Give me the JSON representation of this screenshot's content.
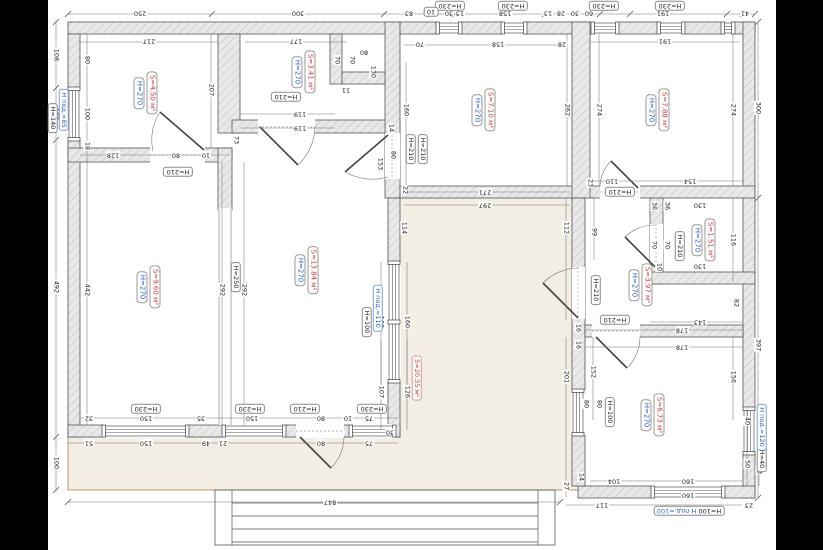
{
  "title": "floor-plan-drawing",
  "colors": {
    "background_bars": "#000000",
    "paper": "#ffffff",
    "wall_fill": "#e9e9e9",
    "wall_hatch": "#c2c2c2",
    "wall_stroke": "#555555",
    "dimension_line": "#777777",
    "text": "#222222",
    "height_tag_blue": "#2b62c4",
    "area_tag_red": "#cc3a3a",
    "terrace_fill": "#f3eee3",
    "terrace_edge": "#c8966b"
  },
  "rooms": [
    {
      "height": "H=270",
      "area": "S=4.50 м²",
      "x": 145,
      "y": 93
    },
    {
      "height": "H=270",
      "area": "S=3.41 м²",
      "x": 303,
      "y": 72
    },
    {
      "height": "H=270",
      "area": "S=7.10 м²",
      "x": 483,
      "y": 110
    },
    {
      "height": "H=270",
      "area": "S=7.88 м²",
      "x": 657,
      "y": 110
    },
    {
      "height": "H=270",
      "area": "S=9.60 м²",
      "x": 148,
      "y": 287
    },
    {
      "height": "H=270",
      "area": "S=13.84 м²",
      "x": 306,
      "y": 270
    },
    {
      "height": "H=270",
      "area": "S=1.51 м²",
      "x": 703,
      "y": 240
    },
    {
      "height": "H=270",
      "area": "S=3.97 м²",
      "x": 640,
      "y": 285
    },
    {
      "height": "H=270",
      "area": "S=6.73 м²",
      "x": 652,
      "y": 415
    }
  ],
  "area_tags": [
    {
      "text": "S=20.35 м²",
      "x": 417,
      "y": 378,
      "o": "v"
    }
  ],
  "height_tags": [
    {
      "text": "H=210",
      "x": 178,
      "y": 172,
      "o": "h"
    },
    {
      "text": "H=210",
      "x": 286,
      "y": 97,
      "o": "h"
    },
    {
      "text": "H=210",
      "x": 411,
      "y": 149,
      "o": "v"
    },
    {
      "text": "H=210",
      "x": 423,
      "y": 149,
      "o": "v"
    },
    {
      "text": "H=210",
      "x": 620,
      "y": 192,
      "o": "h"
    },
    {
      "text": "H=210",
      "x": 680,
      "y": 246,
      "o": "v"
    },
    {
      "text": "H=210",
      "x": 596,
      "y": 290,
      "o": "v"
    },
    {
      "text": "H=210",
      "x": 615,
      "y": 320,
      "o": "h"
    },
    {
      "text": "H=210",
      "x": 305,
      "y": 409,
      "o": "h"
    },
    {
      "text": "H=250",
      "x": 236,
      "y": 277,
      "o": "v"
    },
    {
      "text": "H=230",
      "x": 450,
      "y": 6,
      "o": "h"
    },
    {
      "text": "H=230",
      "x": 513,
      "y": 6,
      "o": "h"
    },
    {
      "text": "H=230",
      "x": 604,
      "y": 6,
      "o": "h"
    },
    {
      "text": "H=230",
      "x": 670,
      "y": 6,
      "o": "h"
    },
    {
      "text": "H=230",
      "x": 146,
      "y": 409,
      "o": "h"
    },
    {
      "text": "H=230",
      "x": 250,
      "y": 409,
      "o": "h"
    },
    {
      "text": "H=230",
      "x": 372,
      "y": 409,
      "o": "h"
    },
    {
      "text": "H=140",
      "x": 53,
      "y": 118,
      "o": "v"
    },
    {
      "text": "H=100",
      "x": 367,
      "y": 322,
      "o": "v"
    },
    {
      "text": "H=100",
      "x": 610,
      "y": 412,
      "o": "v"
    },
    {
      "text": "H=40",
      "x": 762,
      "y": 459,
      "o": "v"
    },
    {
      "text": "10",
      "x": 431,
      "y": 12,
      "o": "h"
    }
  ],
  "sill_tags": [
    {
      "text": "H под.=85",
      "x": 64,
      "y": 110,
      "o": "v"
    },
    {
      "text": "H под.=110",
      "x": 378,
      "y": 308,
      "o": "v"
    },
    {
      "text": "H под.=120",
      "x": 762,
      "y": 427,
      "o": "v"
    }
  ],
  "combo_tag": {
    "black": "H=100",
    "blue": "H под.=100",
    "x": 689,
    "y": 511
  },
  "dimensions": [
    {
      "t": "250",
      "x": 140,
      "y": 13,
      "o": "h"
    },
    {
      "t": "300",
      "x": 298,
      "y": 13,
      "o": "h"
    },
    {
      "t": "83",
      "x": 409,
      "y": 13,
      "o": "h"
    },
    {
      "t": "30",
      "x": 449,
      "y": 13,
      "o": "h"
    },
    {
      "t": "13",
      "x": 460,
      "y": 13,
      "o": "h"
    },
    {
      "t": "158",
      "x": 505,
      "y": 13,
      "o": "h"
    },
    {
      "t": "13",
      "x": 548,
      "y": 13,
      "o": "h"
    },
    {
      "t": "28",
      "x": 561,
      "y": 13,
      "o": "h"
    },
    {
      "t": "30",
      "x": 575,
      "y": 13,
      "o": "h"
    },
    {
      "t": "60",
      "x": 589,
      "y": 13,
      "o": "h"
    },
    {
      "t": "191",
      "x": 663,
      "y": 13,
      "o": "h"
    },
    {
      "t": "41",
      "x": 745,
      "y": 13,
      "o": "h"
    },
    {
      "t": "217",
      "x": 149,
      "y": 41,
      "o": "h"
    },
    {
      "t": "177",
      "x": 296,
      "y": 41,
      "o": "h"
    },
    {
      "t": "70",
      "x": 420,
      "y": 44,
      "o": "h"
    },
    {
      "t": "158",
      "x": 498,
      "y": 44,
      "o": "h"
    },
    {
      "t": "28",
      "x": 562,
      "y": 44,
      "o": "h"
    },
    {
      "t": "191",
      "x": 665,
      "y": 41,
      "o": "h"
    },
    {
      "t": "108",
      "x": 56,
      "y": 55,
      "o": "v"
    },
    {
      "t": "100",
      "x": 56,
      "y": 114,
      "o": "v"
    },
    {
      "t": "492",
      "x": 56,
      "y": 287,
      "o": "v"
    },
    {
      "t": "100",
      "x": 56,
      "y": 463,
      "o": "v"
    },
    {
      "t": "80",
      "x": 87,
      "y": 60,
      "o": "v"
    },
    {
      "t": "100",
      "x": 87,
      "y": 114,
      "o": "v"
    },
    {
      "t": "18",
      "x": 87,
      "y": 146,
      "o": "v"
    },
    {
      "t": "442",
      "x": 87,
      "y": 290,
      "o": "v"
    },
    {
      "t": "207",
      "x": 211,
      "y": 90,
      "o": "v"
    },
    {
      "t": "128",
      "x": 113,
      "y": 155,
      "o": "h"
    },
    {
      "t": "80",
      "x": 176,
      "y": 155,
      "o": "h"
    },
    {
      "t": "10",
      "x": 206,
      "y": 155,
      "o": "h"
    },
    {
      "t": "119",
      "x": 300,
      "y": 114,
      "o": "h"
    },
    {
      "t": "119",
      "x": 300,
      "y": 128,
      "o": "h"
    },
    {
      "t": "70",
      "x": 337,
      "y": 60,
      "o": "v"
    },
    {
      "t": "70",
      "x": 352,
      "y": 60,
      "o": "v"
    },
    {
      "t": "80",
      "x": 364,
      "y": 52,
      "o": "h"
    },
    {
      "t": "11",
      "x": 346,
      "y": 90,
      "o": "h"
    },
    {
      "t": "130",
      "x": 373,
      "y": 72,
      "o": "v"
    },
    {
      "t": "14",
      "x": 391,
      "y": 128,
      "o": "v"
    },
    {
      "t": "73",
      "x": 236,
      "y": 140,
      "o": "v"
    },
    {
      "t": "80",
      "x": 393,
      "y": 155,
      "o": "v"
    },
    {
      "t": "160",
      "x": 406,
      "y": 110,
      "o": "v"
    },
    {
      "t": "292",
      "x": 222,
      "y": 290,
      "o": "v"
    },
    {
      "t": "292",
      "x": 244,
      "y": 290,
      "o": "v"
    },
    {
      "t": "153",
      "x": 380,
      "y": 164,
      "o": "v"
    },
    {
      "t": "114",
      "x": 404,
      "y": 228,
      "o": "v"
    },
    {
      "t": "160",
      "x": 381,
      "y": 322,
      "o": "v"
    },
    {
      "t": "160",
      "x": 407,
      "y": 322,
      "o": "v"
    },
    {
      "t": "271",
      "x": 485,
      "y": 192,
      "o": "h"
    },
    {
      "t": "297",
      "x": 485,
      "y": 205,
      "o": "h"
    },
    {
      "t": "22",
      "x": 405,
      "y": 190,
      "o": "v"
    },
    {
      "t": "107",
      "x": 381,
      "y": 392,
      "o": "v"
    },
    {
      "t": "126",
      "x": 407,
      "y": 392,
      "o": "v"
    },
    {
      "t": "30",
      "x": 390,
      "y": 432,
      "o": "h"
    },
    {
      "t": "75",
      "x": 369,
      "y": 418,
      "o": "h"
    },
    {
      "t": "75",
      "x": 369,
      "y": 443,
      "o": "h"
    },
    {
      "t": "32",
      "x": 89,
      "y": 418,
      "o": "h"
    },
    {
      "t": "150",
      "x": 146,
      "y": 418,
      "o": "h"
    },
    {
      "t": "35",
      "x": 201,
      "y": 418,
      "o": "h"
    },
    {
      "t": "150",
      "x": 252,
      "y": 418,
      "o": "h"
    },
    {
      "t": "80",
      "x": 321,
      "y": 418,
      "o": "h"
    },
    {
      "t": "10",
      "x": 348,
      "y": 418,
      "o": "h"
    },
    {
      "t": "51",
      "x": 89,
      "y": 443,
      "o": "h"
    },
    {
      "t": "150",
      "x": 146,
      "y": 443,
      "o": "h"
    },
    {
      "t": "49",
      "x": 206,
      "y": 443,
      "o": "h"
    },
    {
      "t": "21",
      "x": 223,
      "y": 443,
      "o": "h"
    },
    {
      "t": "80",
      "x": 321,
      "y": 443,
      "o": "h"
    },
    {
      "t": "847",
      "x": 330,
      "y": 502,
      "o": "h"
    },
    {
      "t": "262",
      "x": 567,
      "y": 110,
      "o": "v"
    },
    {
      "t": "274",
      "x": 599,
      "y": 110,
      "o": "v"
    },
    {
      "t": "274",
      "x": 733,
      "y": 110,
      "o": "v"
    },
    {
      "t": "300",
      "x": 758,
      "y": 108,
      "o": "v"
    },
    {
      "t": "110",
      "x": 612,
      "y": 181,
      "o": "h"
    },
    {
      "t": "154",
      "x": 690,
      "y": 181,
      "o": "h"
    },
    {
      "t": "23",
      "x": 590,
      "y": 183,
      "o": "v"
    },
    {
      "t": "112",
      "x": 566,
      "y": 228,
      "o": "v"
    },
    {
      "t": "99",
      "x": 594,
      "y": 232,
      "o": "v"
    },
    {
      "t": "36",
      "x": 654,
      "y": 206,
      "o": "v"
    },
    {
      "t": "36",
      "x": 667,
      "y": 206,
      "o": "v"
    },
    {
      "t": "130",
      "x": 700,
      "y": 205,
      "o": "h"
    },
    {
      "t": "116",
      "x": 733,
      "y": 240,
      "o": "v"
    },
    {
      "t": "70",
      "x": 654,
      "y": 245,
      "o": "v"
    },
    {
      "t": "70",
      "x": 667,
      "y": 245,
      "o": "v"
    },
    {
      "t": "10",
      "x": 659,
      "y": 267,
      "o": "v"
    },
    {
      "t": "130",
      "x": 700,
      "y": 266,
      "o": "h"
    },
    {
      "t": "143",
      "x": 700,
      "y": 322,
      "o": "h"
    },
    {
      "t": "82",
      "x": 736,
      "y": 303,
      "o": "v"
    },
    {
      "t": "178",
      "x": 682,
      "y": 330,
      "o": "h"
    },
    {
      "t": "178",
      "x": 682,
      "y": 347,
      "o": "h"
    },
    {
      "t": "16",
      "x": 578,
      "y": 328,
      "o": "v"
    },
    {
      "t": "16",
      "x": 578,
      "y": 345,
      "o": "v"
    },
    {
      "t": "397",
      "x": 758,
      "y": 345,
      "o": "v"
    },
    {
      "t": "201",
      "x": 566,
      "y": 377,
      "o": "v"
    },
    {
      "t": "152",
      "x": 593,
      "y": 372,
      "o": "v"
    },
    {
      "t": "156",
      "x": 733,
      "y": 377,
      "o": "v"
    },
    {
      "t": "80",
      "x": 586,
      "y": 404,
      "o": "v"
    },
    {
      "t": "80",
      "x": 599,
      "y": 404,
      "o": "v"
    },
    {
      "t": "40",
      "x": 747,
      "y": 421,
      "o": "v"
    },
    {
      "t": "40",
      "x": 759,
      "y": 421,
      "o": "v"
    },
    {
      "t": "50",
      "x": 747,
      "y": 464,
      "o": "v"
    },
    {
      "t": "63",
      "x": 759,
      "y": 470,
      "o": "v"
    },
    {
      "t": "14",
      "x": 581,
      "y": 477,
      "o": "v"
    },
    {
      "t": "27",
      "x": 566,
      "y": 486,
      "o": "v"
    },
    {
      "t": "104",
      "x": 614,
      "y": 481,
      "o": "h"
    },
    {
      "t": "160",
      "x": 688,
      "y": 481,
      "o": "h"
    },
    {
      "t": "160",
      "x": 688,
      "y": 495,
      "o": "h"
    },
    {
      "t": "117",
      "x": 602,
      "y": 505,
      "o": "h"
    },
    {
      "t": "23",
      "x": 749,
      "y": 505,
      "o": "h"
    }
  ]
}
